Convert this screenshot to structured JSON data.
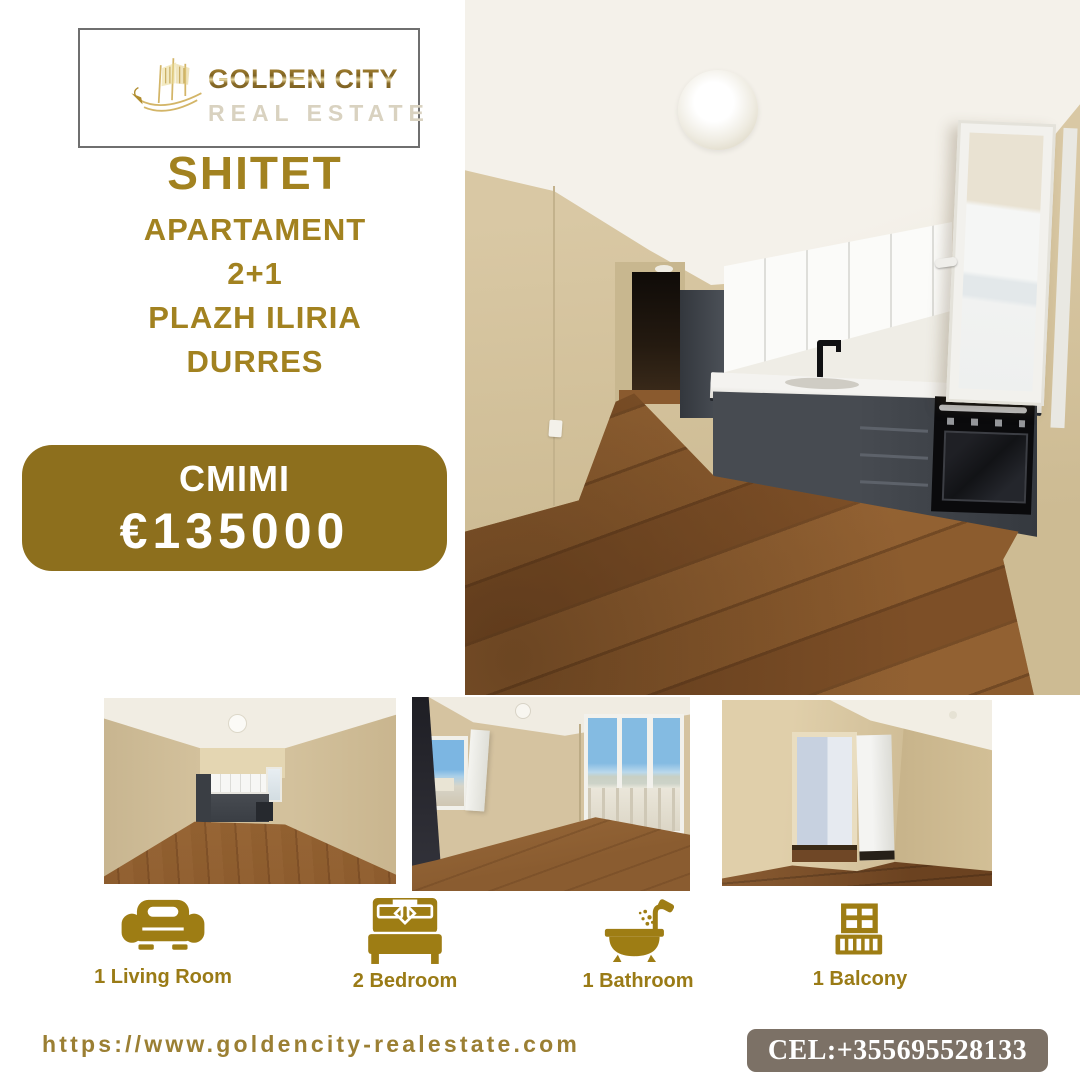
{
  "page": {
    "background": "#ffffff"
  },
  "logo": {
    "company": "GOLDEN CITY",
    "tagline": "REAL ESTATE",
    "icon": "golden-ship-icon"
  },
  "headline": {
    "status": "SHITET",
    "property_type": "APARTAMENT",
    "layout": "2+1",
    "area": "PLAZH ILIRIA",
    "city": "DURRES"
  },
  "price": {
    "label": "CMIMI",
    "value": "€135000"
  },
  "photos": {
    "main": "kitchen-and-living-area-with-wood-floor",
    "thumb1": "living-room-view-toward-kitchen",
    "thumb2": "room-with-open-window-and-balcony-glass-doors",
    "thumb3": "hallway-with-open-doorway-and-white-door"
  },
  "features": [
    {
      "icon": "sofa-icon",
      "label": "1 Living Room"
    },
    {
      "icon": "bed-icon",
      "label": "2 Bedroom"
    },
    {
      "icon": "bathtub-icon",
      "label": "1 Bathroom"
    },
    {
      "icon": "balcony-icon",
      "label": "1 Balcony"
    }
  ],
  "footer": {
    "website": "https://www.goldencity-realestate.com",
    "phone": "CEL:+355695528133"
  },
  "colors": {
    "gold_text": "#a28220",
    "price_box": "#8d6f1d",
    "icon_gold": "#9e7d14",
    "phone_box": "#7c7166",
    "logo_silver": "#d9d2c0"
  }
}
